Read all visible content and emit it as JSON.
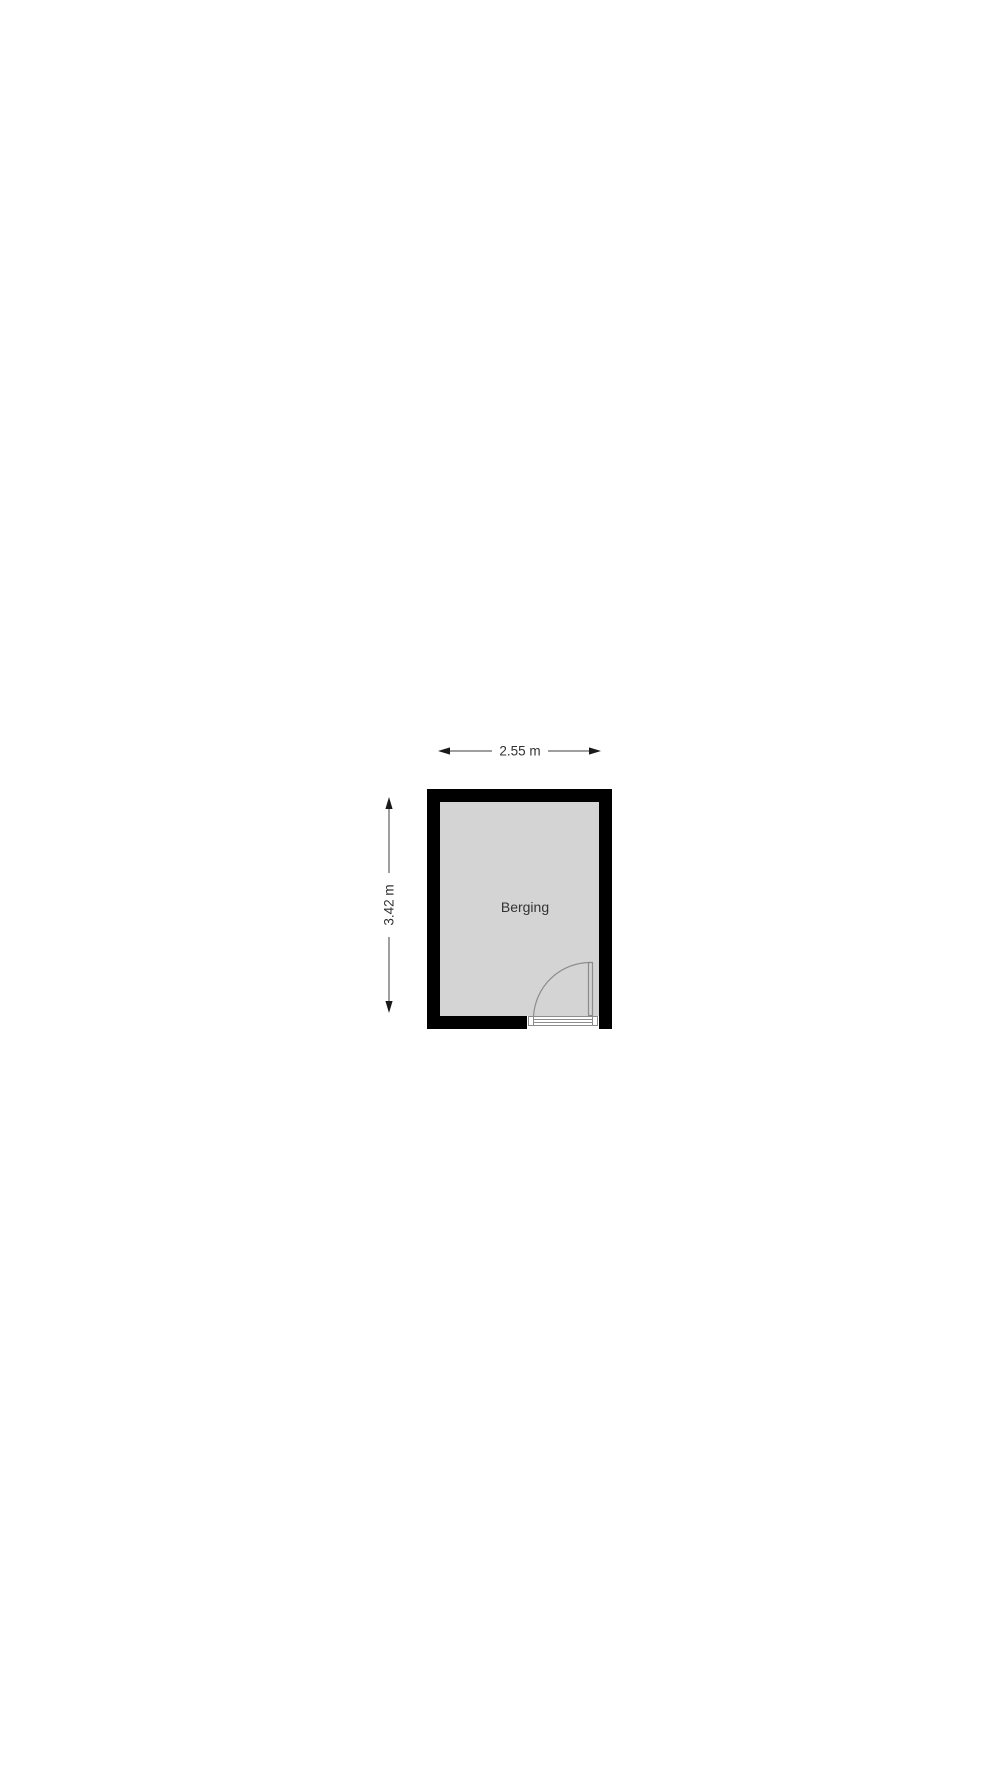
{
  "page": {
    "background": "#ffffff"
  },
  "floor_plan": {
    "room_label": "Berging",
    "width_dimension": "2.55 m",
    "height_dimension": "3.42 m",
    "colors": {
      "wall": "#000000",
      "floor": "#d4d4d4",
      "door_lines": "#8c8c8c",
      "dimension_lines": "#3f3f3f",
      "label_text": "#333333"
    }
  }
}
